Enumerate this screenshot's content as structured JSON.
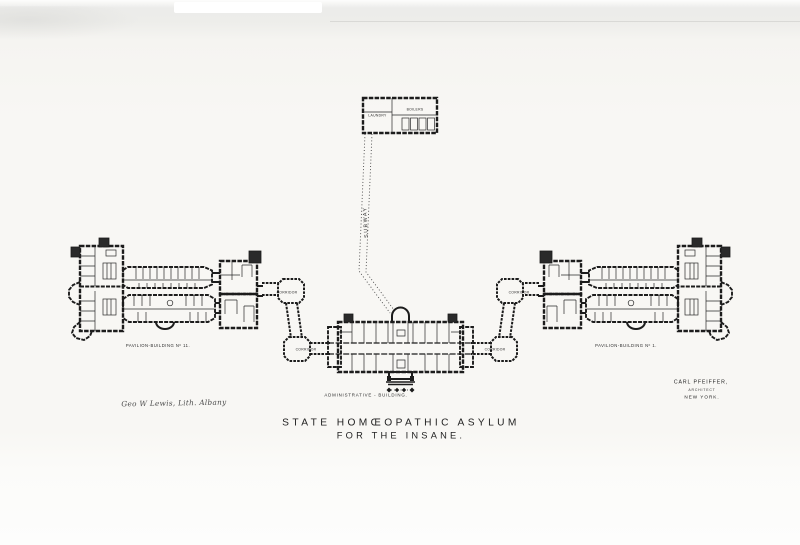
{
  "title": {
    "line1": "STATE HOMŒOPATHIC ASYLUM",
    "line2": "FOR THE INSANE."
  },
  "buildings": {
    "administrative": {
      "label": "ADMINISTRATIVE - BUILDING."
    },
    "pavilion_left": {
      "label": "PAVILION-BUILDING Nº 11."
    },
    "pavilion_right": {
      "label": "PAVILION-BUILDING Nº 1."
    },
    "boiler_house": {
      "laundry": "LAUNDRY",
      "boilers": "BOILERS"
    },
    "subway": {
      "label": "SUBWAY"
    },
    "corridor": {
      "label": "CORRIDOR"
    }
  },
  "credits": {
    "architect_name": "CARL PFEIFFER,",
    "architect_title": "ARCHITECT",
    "architect_city": "NEW YORK.",
    "lithographer": "Geo W Lewis, Lith. Albany"
  },
  "colors": {
    "ink": "#1c1c1c",
    "paper": "#f8f7f4",
    "scan_band": "#ededea"
  }
}
